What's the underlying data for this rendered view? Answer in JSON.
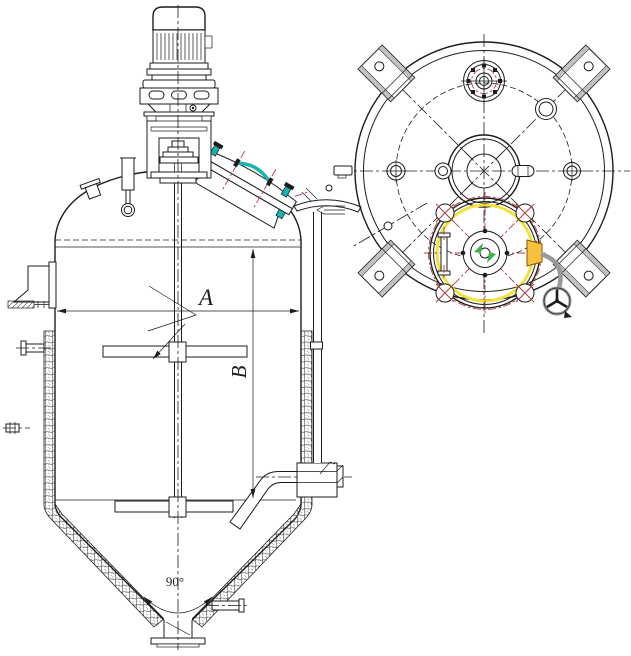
{
  "drawing": {
    "labels": {
      "dim_a": "A",
      "dim_b": "B",
      "cone_angle": "90°"
    }
  },
  "colors": {
    "bg": "#ffffff",
    "line": "#1c1c1c",
    "red": "#a84040",
    "teal": "#17b3ae",
    "yellow": "#f2e23a",
    "orange_fill": "#f5c23c",
    "orange_stroke": "#8a5200",
    "green": "#3cb24a",
    "gray": "#999999",
    "grayfill": "#c2c2c2"
  }
}
